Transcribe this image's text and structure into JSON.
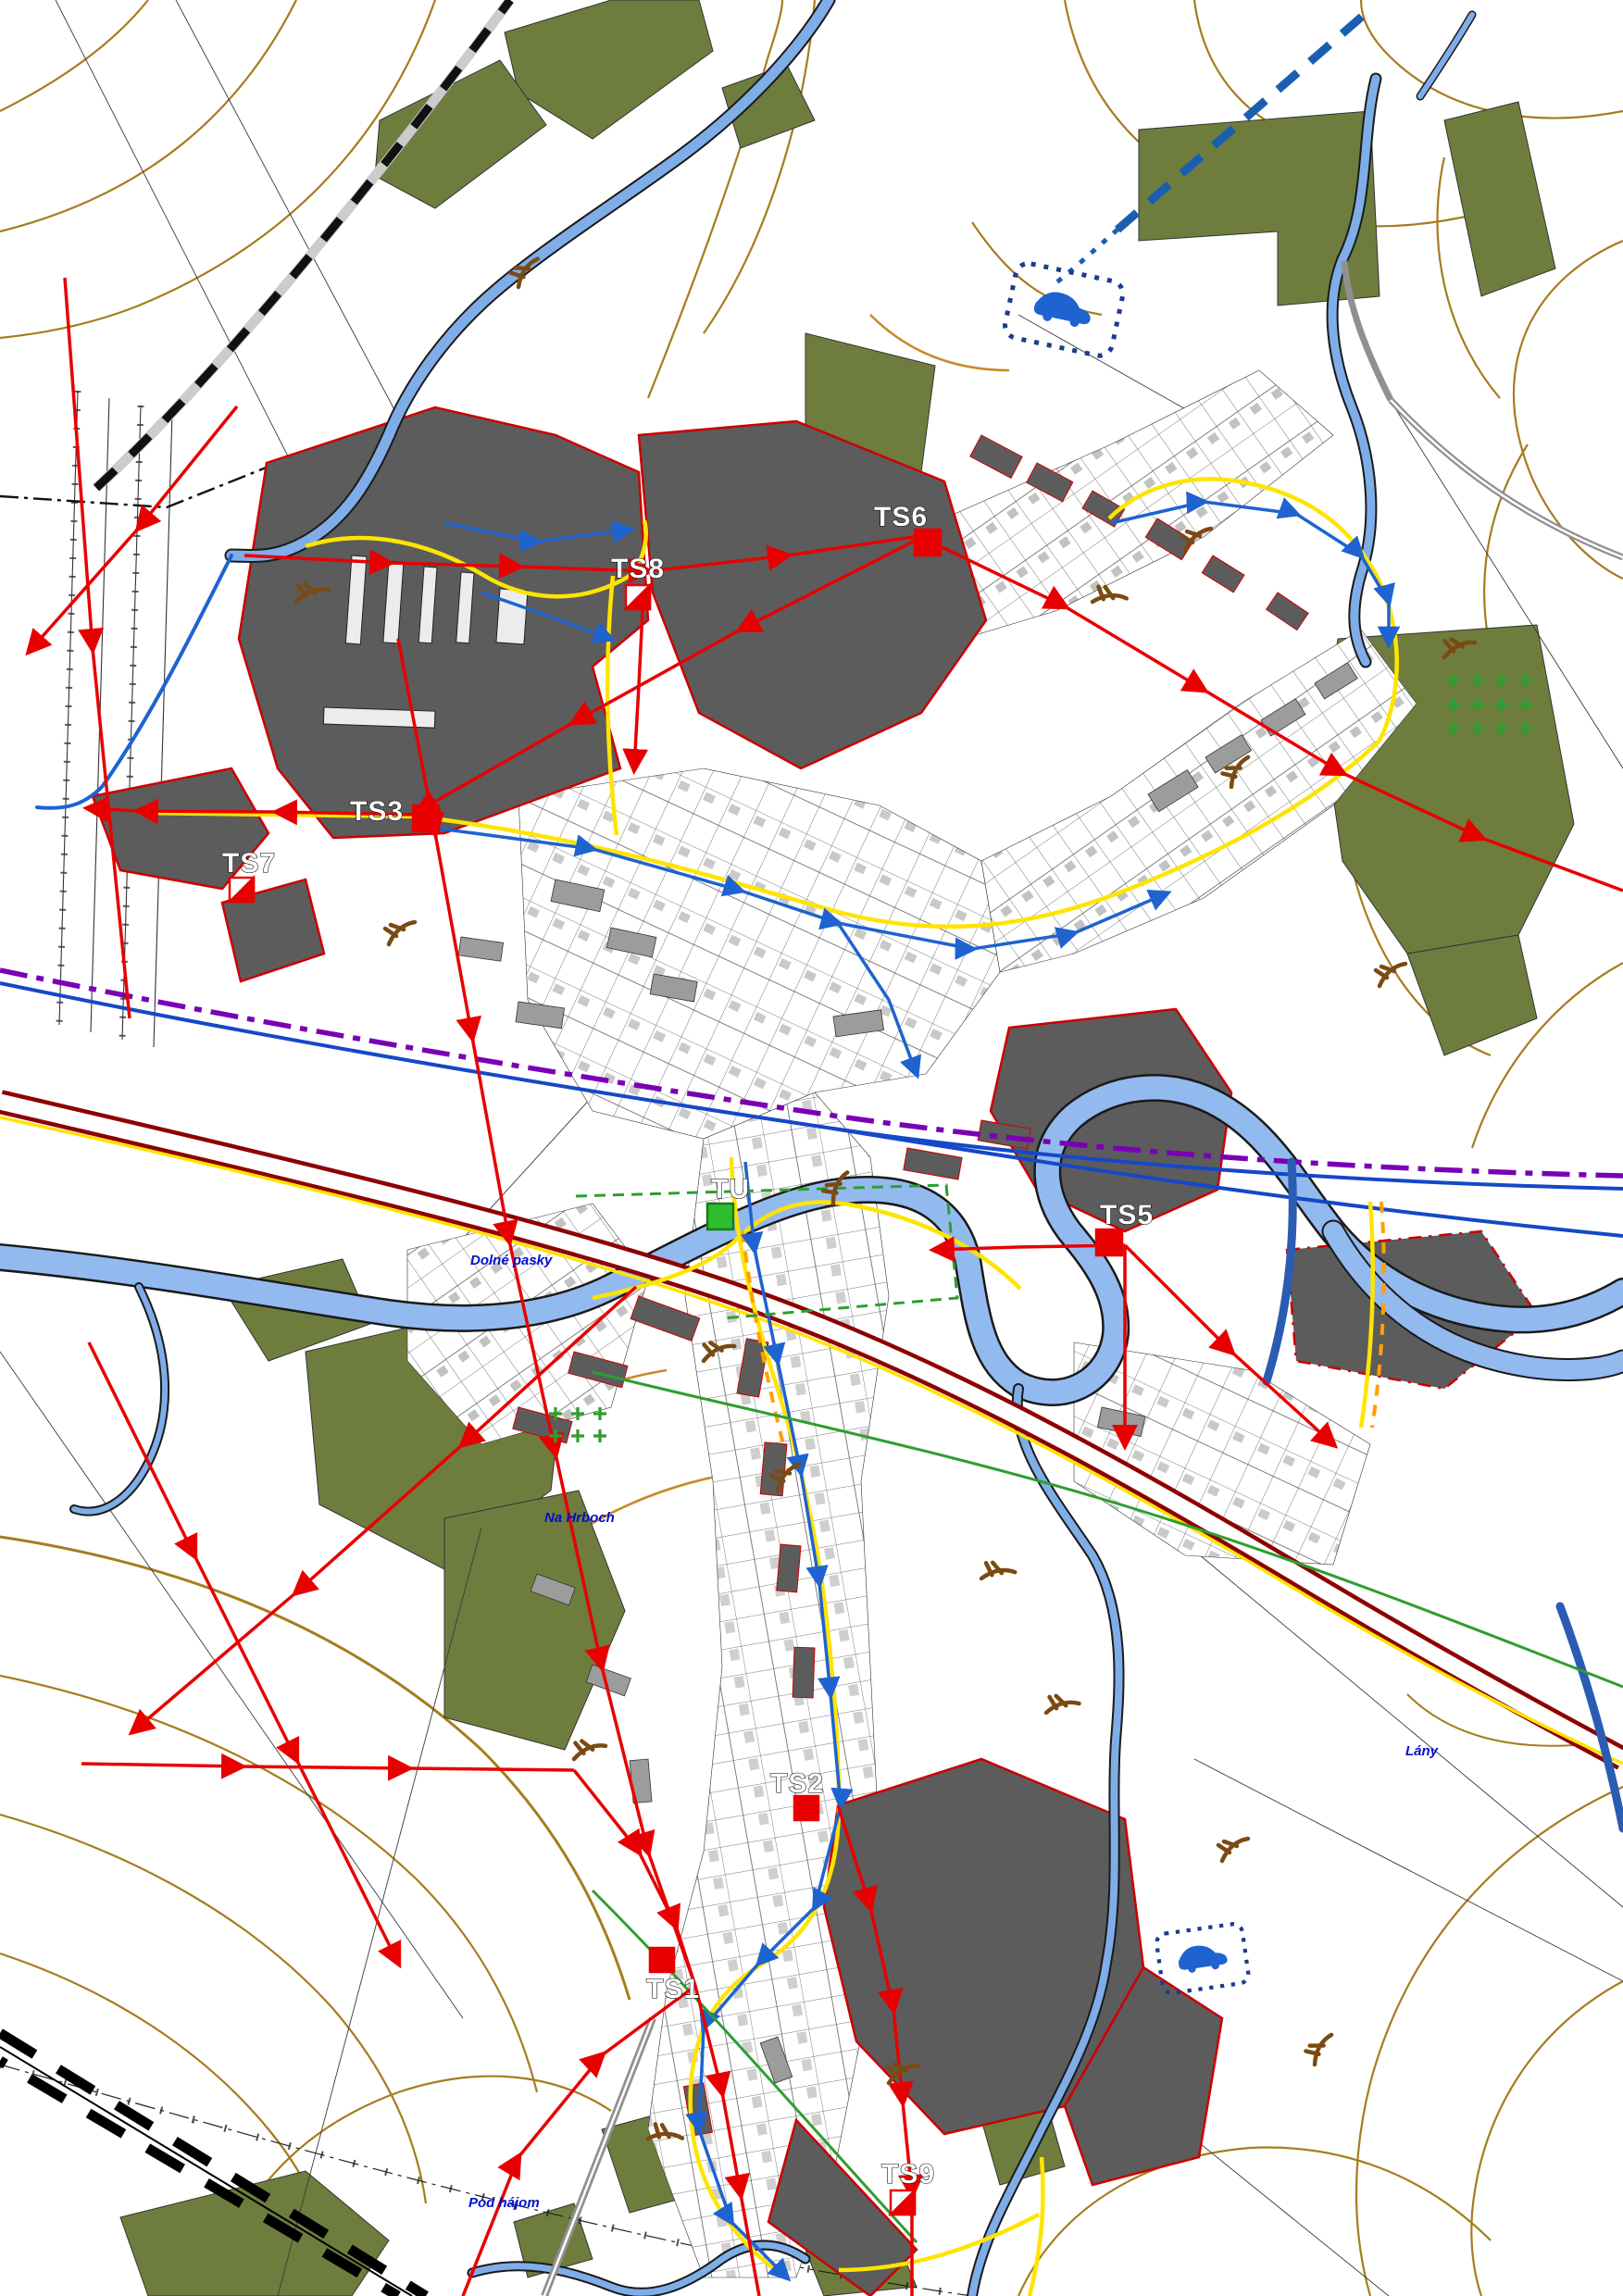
{
  "palette": {
    "background": "#ffffff",
    "contour": "#a67c1e",
    "contour_secondary": "#c8892b",
    "vegetation": "#6e7d3e",
    "built_area": "#5c5c5c",
    "built_area_border": "#cc0000",
    "parcel_gray": "#9c9c9c",
    "river": "#93baef",
    "main_road": "#8e0000",
    "power_line": "#e80000",
    "gas_line": "#ffe400",
    "gas_line_secondary": "#ffa000",
    "water_line": "#1e63d0",
    "telecom_line": "#2e9e30",
    "boundary_purple": "#7a00b4",
    "planned_road_blue": "#1a5faf",
    "railway": "#000000",
    "place_name_text": "#0011cc",
    "station_marker_green": "#2dbe2d"
  },
  "stations": [
    {
      "id": "ts8",
      "label": "TS8",
      "marker": "half-filled-red-square"
    },
    {
      "id": "ts6",
      "label": "TS6",
      "marker": "filled-red-square"
    },
    {
      "id": "ts3",
      "label": "TS3",
      "marker": "filled-red-square"
    },
    {
      "id": "ts7",
      "label": "TS7",
      "marker": "half-filled-red-square"
    },
    {
      "id": "ts5",
      "label": "TS5",
      "marker": "filled-red-square"
    },
    {
      "id": "tu",
      "label": "TU",
      "marker": "filled-green-square"
    },
    {
      "id": "ts2",
      "label": "TS2",
      "marker": "filled-red-square"
    },
    {
      "id": "ts1",
      "label": "TS1",
      "marker": "filled-red-square"
    },
    {
      "id": "ts9",
      "label": "TS9",
      "marker": "half-filled-red-square"
    }
  ],
  "place_names": [
    {
      "id": "dolne-pasky",
      "label": "Dolné pasky"
    },
    {
      "id": "na-hrboch",
      "label": "Na Hrboch"
    },
    {
      "id": "lany",
      "label": "Lány"
    },
    {
      "id": "pod-hajom",
      "label": "Pod hájom"
    }
  ]
}
